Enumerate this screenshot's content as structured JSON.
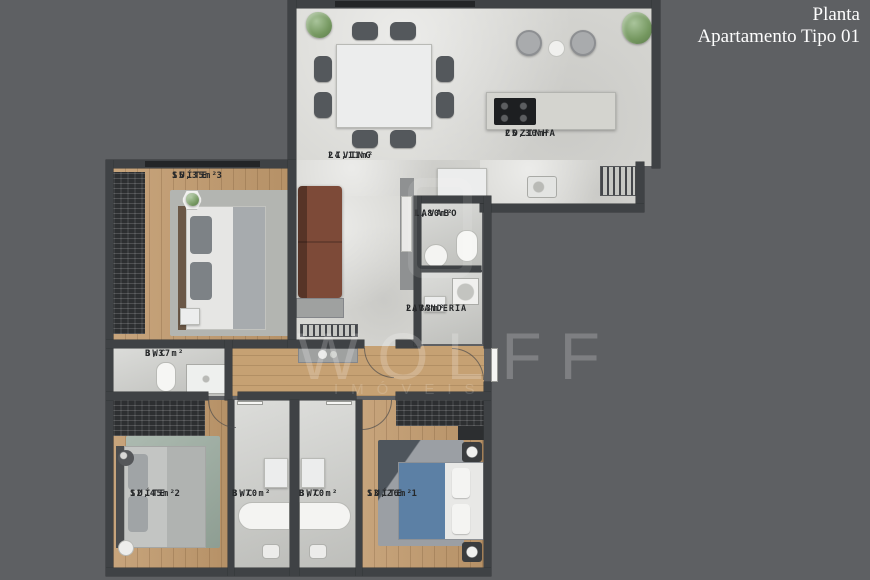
{
  "title": {
    "line1": "Planta",
    "line2": "Apartamento Tipo 01"
  },
  "watermark": {
    "brand": "WOLFF",
    "sub": "IMÓVEIS"
  },
  "rooms": {
    "suite3": {
      "name": "SUÍTE 3",
      "area": "15,35m²"
    },
    "living": {
      "name": "LIVING",
      "area": "24,11m²"
    },
    "cozinha": {
      "name": "COZINHA",
      "area": "25,30m²"
    },
    "lavabo": {
      "name": "LAVABO",
      "area": "1,80m²"
    },
    "lavanderia": {
      "name": "LAVANDERIA",
      "area": "2,33m²"
    },
    "bwc_social": {
      "name": "BWC",
      "area": "3,37m²"
    },
    "suite2": {
      "name": "SUÍTE 2",
      "area": "12,45m²"
    },
    "bwc_suite2": {
      "name": "BWC",
      "area": "3,70m²"
    },
    "bwc_suite1": {
      "name": "BWC",
      "area": "3,70m²"
    },
    "suite1": {
      "name": "SUÍTE 1",
      "area": "13,26m²"
    }
  },
  "colors": {
    "background": "#5e6063",
    "wall": "#3f4245",
    "floor_marble": "#d8d8d4",
    "floor_wood": "#c19a6d",
    "sofa_brown": "#7d4a38",
    "bed_suite1_blue": "#5c80a5",
    "rug_suite2_green": "#9aab9f",
    "title_text": "#fdfdfd"
  }
}
